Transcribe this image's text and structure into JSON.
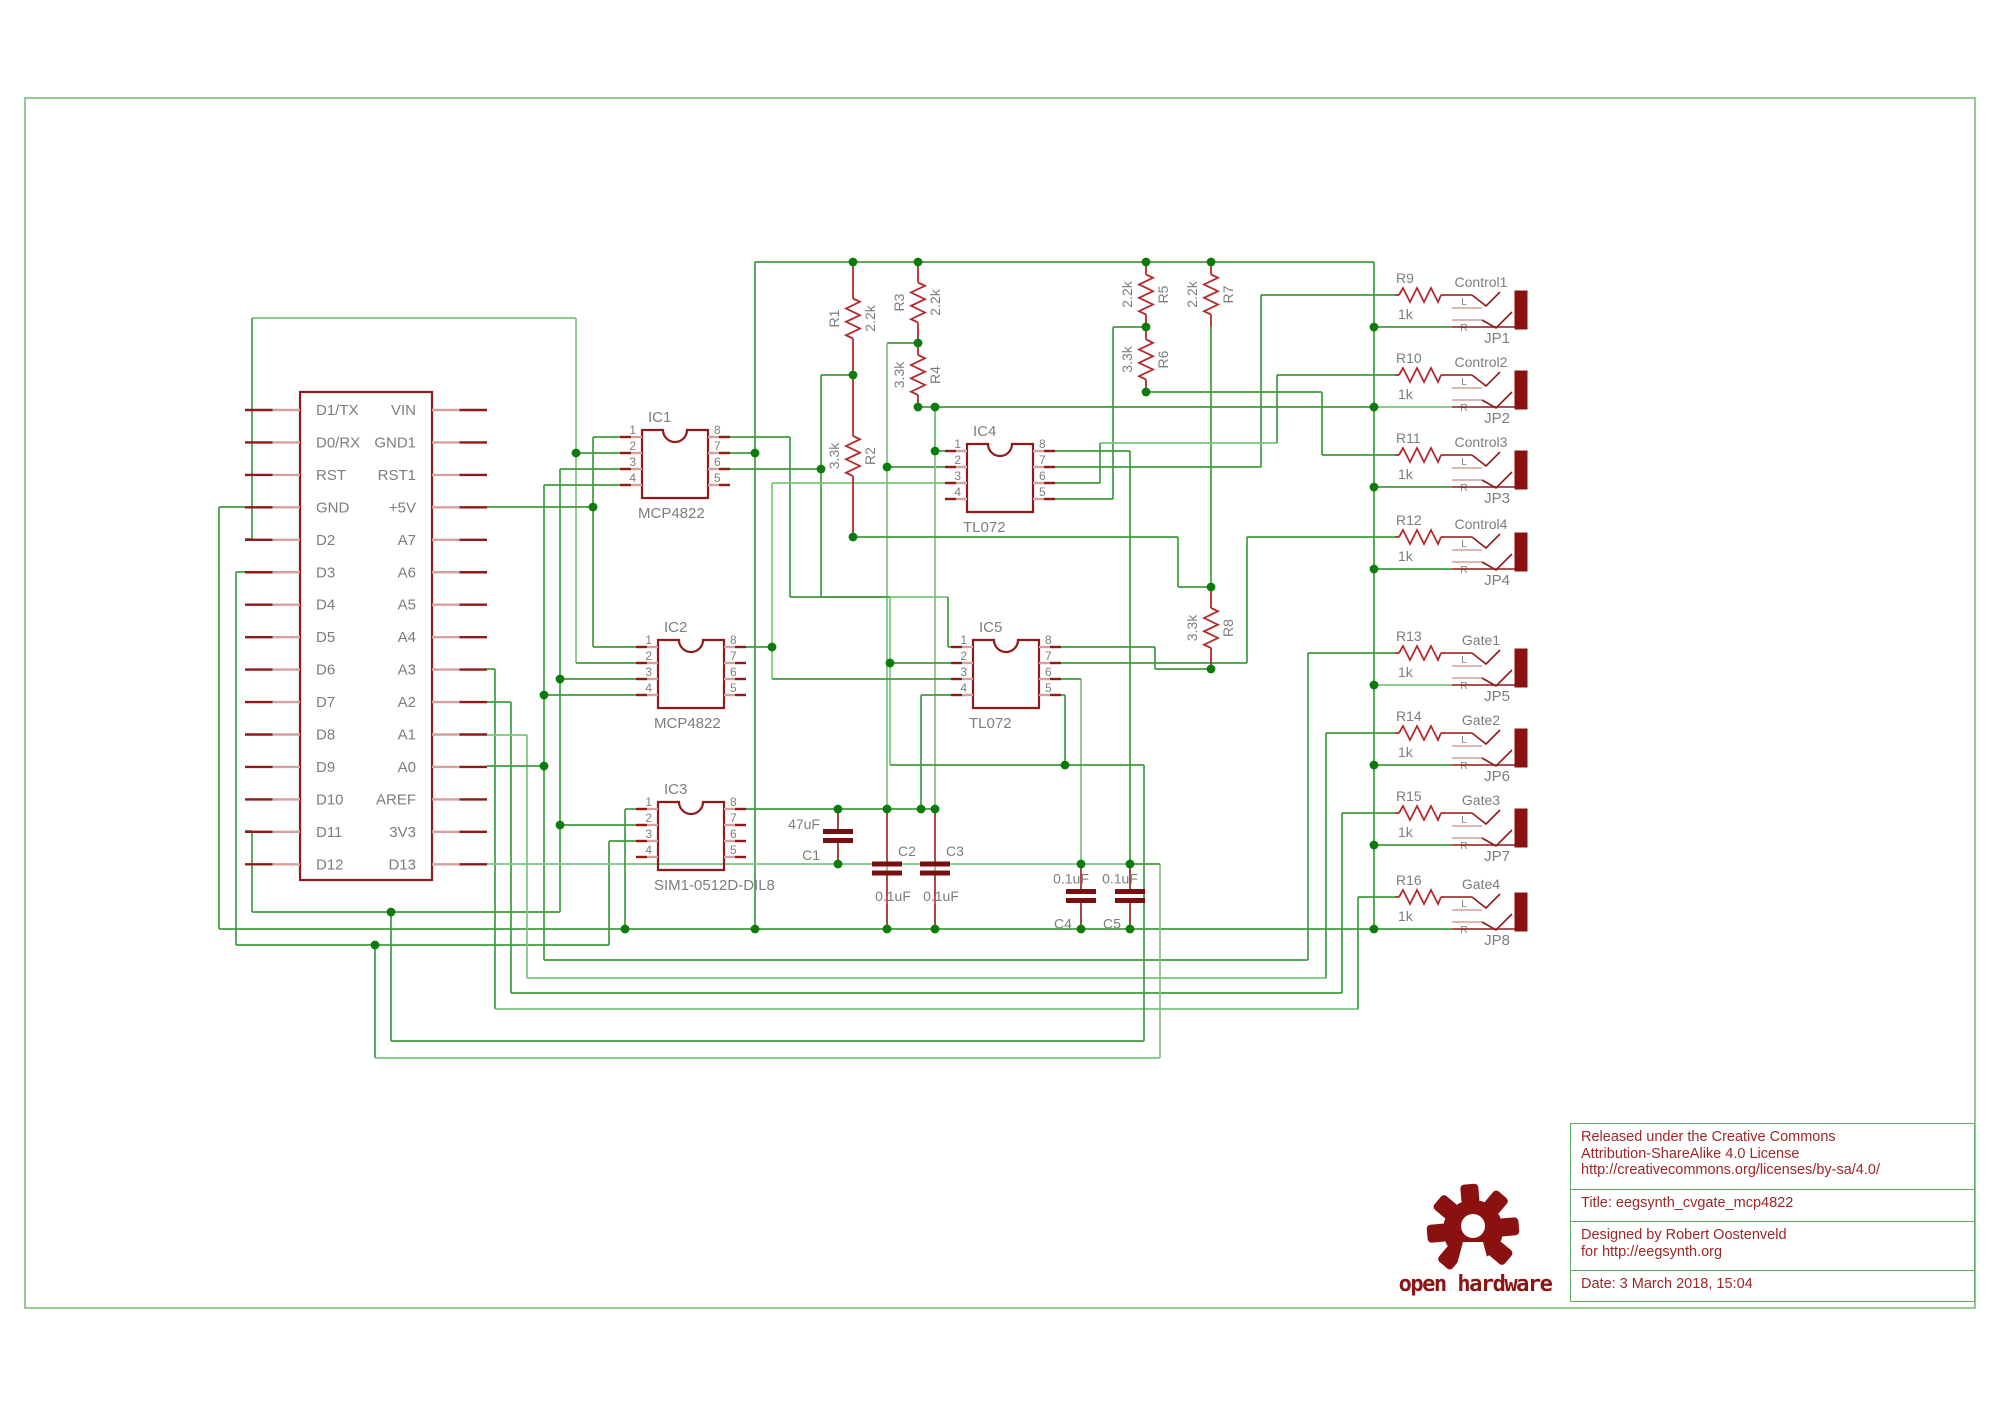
{
  "title_block": {
    "license_lines": [
      "Released under the Creative Commons",
      "Attribution-ShareAlike 4.0 License",
      "http://creativecommons.org/licenses/by-sa/4.0/"
    ],
    "title": "Title: eegsynth_cvgate_mcp4822",
    "designed_lines": [
      "Designed by Robert Oostenveld",
      "for http://eegsynth.org"
    ],
    "date": "Date: 3 March 2018, 15:04"
  },
  "logo": {
    "text": "open hardware"
  },
  "colors": {
    "wire": "#3f9b3f",
    "wire_light": "#7cc57c",
    "junction": "#0b7c0b",
    "symbol": "#8f1a1a",
    "resistor": "#b22a2a",
    "pin_near": "#d4a0a0",
    "pin_far": "#8f1a1a",
    "label": "#7d7d7d",
    "frame": "#66b266",
    "jack_body": "#8b1111",
    "cap": "#7a0f0f"
  },
  "frame": {
    "x": 25,
    "y": 98,
    "w": 1950,
    "h": 1210
  },
  "schematic": {
    "mcu": {
      "x": 300,
      "y": 392,
      "w": 132,
      "h": 488,
      "stub": 55,
      "row0": 410,
      "rowstep": 32.45,
      "left_pins": [
        "D1/TX",
        "D0/RX",
        "RST",
        "GND",
        "D2",
        "D3",
        "D4",
        "D5",
        "D6",
        "D7",
        "D8",
        "D9",
        "D10",
        "D11",
        "D12"
      ],
      "right_pins": [
        "VIN",
        "GND1",
        "RST1",
        "+5V",
        "A7",
        "A6",
        "A5",
        "A4",
        "A3",
        "A2",
        "A1",
        "A0",
        "AREF",
        "3V3",
        "D13"
      ]
    },
    "ics": [
      {
        "ref": "IC1",
        "value": "MCP4822",
        "x": 642,
        "y": 430,
        "w": 66,
        "h": 68
      },
      {
        "ref": "IC2",
        "value": "MCP4822",
        "x": 658,
        "y": 640,
        "w": 66,
        "h": 68
      },
      {
        "ref": "IC3",
        "value": "SIM1-0512D-DIL8",
        "x": 658,
        "y": 802,
        "w": 66,
        "h": 68
      },
      {
        "ref": "IC4",
        "value": "TL072",
        "x": 967,
        "y": 444,
        "w": 66,
        "h": 68
      },
      {
        "ref": "IC5",
        "value": "TL072",
        "x": 973,
        "y": 640,
        "w": 66,
        "h": 68
      }
    ],
    "ic_pin_numbers_left": [
      "1",
      "2",
      "3",
      "4"
    ],
    "ic_pin_numbers_right": [
      "8",
      "7",
      "6",
      "5"
    ],
    "vresistors": [
      {
        "ref": "R1",
        "value": "2.2k",
        "x": 853,
        "y1": 262,
        "y2": 375,
        "refSide": "left"
      },
      {
        "ref": "R2",
        "value": "3.3k",
        "x": 853,
        "y1": 375,
        "y2": 537,
        "refSide": "right"
      },
      {
        "ref": "R3",
        "value": "2.2k",
        "x": 918,
        "y1": 262,
        "y2": 343,
        "refSide": "left"
      },
      {
        "ref": "R4",
        "value": "3.3k",
        "x": 918,
        "y1": 343,
        "y2": 407,
        "refSide": "right"
      },
      {
        "ref": "R5",
        "value": "2.2k",
        "x": 1146,
        "y1": 262,
        "y2": 327,
        "refSide": "right"
      },
      {
        "ref": "R6",
        "value": "3.3k",
        "x": 1146,
        "y1": 327,
        "y2": 392,
        "refSide": "right"
      },
      {
        "ref": "R7",
        "value": "2.2k",
        "x": 1211,
        "y1": 262,
        "y2": 327,
        "refSide": "right"
      },
      {
        "ref": "R8",
        "value": "3.3k",
        "x": 1211,
        "y1": 587,
        "y2": 669,
        "refSide": "right"
      }
    ],
    "jacks": [
      {
        "jp": "JP1",
        "signal": "Control1",
        "ref": "R9",
        "value": "1k",
        "y": 295
      },
      {
        "jp": "JP2",
        "signal": "Control2",
        "ref": "R10",
        "value": "1k",
        "y": 375
      },
      {
        "jp": "JP3",
        "signal": "Control3",
        "ref": "R11",
        "value": "1k",
        "y": 455
      },
      {
        "jp": "JP4",
        "signal": "Control4",
        "ref": "R12",
        "value": "1k",
        "y": 537
      },
      {
        "jp": "JP5",
        "signal": "Gate1",
        "ref": "R13",
        "value": "1k",
        "y": 653
      },
      {
        "jp": "JP6",
        "signal": "Gate2",
        "ref": "R14",
        "value": "1k",
        "y": 733
      },
      {
        "jp": "JP7",
        "signal": "Gate3",
        "ref": "R15",
        "value": "1k",
        "y": 813
      },
      {
        "jp": "JP8",
        "signal": "Gate4",
        "ref": "R16",
        "value": "1k",
        "y": 897
      }
    ],
    "jack_contact_labels": [
      "L",
      "R"
    ],
    "caps": [
      {
        "ref": "C1",
        "value": "47uF",
        "x": 838,
        "top": 809,
        "bot": 864,
        "layout": "left"
      },
      {
        "ref": "C2",
        "value": "0.1uF",
        "x": 887,
        "top": 809,
        "bot": 929,
        "layout": "refAbove"
      },
      {
        "ref": "C3",
        "value": "0.1uF",
        "x": 935,
        "top": 809,
        "bot": 929,
        "layout": "refAbove"
      },
      {
        "ref": "C4",
        "value": "0.1uF",
        "x": 1081,
        "top": 864,
        "bot": 929,
        "layout": "refBelow"
      },
      {
        "ref": "C5",
        "value": "0.1uF",
        "x": 1130,
        "top": 864,
        "bot": 929,
        "layout": "refBelow"
      }
    ],
    "wires": [
      [
        245,
        507,
        219,
        507
      ],
      [
        219,
        507,
        219,
        929
      ],
      [
        219,
        929,
        1374,
        929
      ],
      [
        755,
        262,
        1374,
        262
      ],
      [
        1374,
        262,
        1374,
        929
      ],
      [
        755,
        262,
        755,
        929
      ],
      [
        1374,
        327,
        1452,
        327
      ],
      [
        1374,
        407,
        1452,
        407
      ],
      [
        1374,
        487,
        1452,
        487
      ],
      [
        1374,
        569,
        1452,
        569
      ],
      [
        1374,
        685,
        1452,
        685
      ],
      [
        1374,
        765,
        1452,
        765
      ],
      [
        1374,
        845,
        1452,
        845
      ],
      [
        1374,
        929,
        1452,
        929
      ],
      [
        245,
        539,
        252,
        539
      ],
      [
        252,
        318,
        252,
        539
      ],
      [
        252,
        318,
        576,
        318
      ],
      [
        576,
        318,
        576,
        663
      ],
      [
        576,
        453,
        620,
        453
      ],
      [
        576,
        663,
        636,
        663
      ],
      [
        245,
        572,
        236,
        572
      ],
      [
        236,
        572,
        236,
        945
      ],
      [
        236,
        945,
        609,
        945
      ],
      [
        609,
        841,
        609,
        945
      ],
      [
        609,
        841,
        636,
        841
      ],
      [
        245,
        831,
        252,
        831
      ],
      [
        252,
        831,
        252,
        912
      ],
      [
        252,
        912,
        560,
        912
      ],
      [
        560,
        469,
        560,
        912
      ],
      [
        560,
        469,
        620,
        469
      ],
      [
        560,
        679,
        636,
        679
      ],
      [
        560,
        825,
        636,
        825
      ],
      [
        487,
        507,
        593,
        507
      ],
      [
        593,
        437,
        593,
        647
      ],
      [
        593,
        437,
        620,
        437
      ],
      [
        593,
        647,
        636,
        647
      ],
      [
        487,
        669,
        495,
        669
      ],
      [
        495,
        669,
        495,
        1009
      ],
      [
        495,
        1009,
        1358,
        1009
      ],
      [
        1358,
        897,
        1358,
        1009
      ],
      [
        1358,
        897,
        1395,
        897
      ],
      [
        487,
        702,
        511,
        702
      ],
      [
        511,
        702,
        511,
        993
      ],
      [
        511,
        993,
        1342,
        993
      ],
      [
        1342,
        813,
        1342,
        993
      ],
      [
        1342,
        813,
        1395,
        813
      ],
      [
        487,
        735,
        527,
        735
      ],
      [
        527,
        735,
        527,
        978
      ],
      [
        527,
        978,
        1326,
        978
      ],
      [
        1326,
        733,
        1326,
        978
      ],
      [
        1326,
        733,
        1395,
        733
      ],
      [
        487,
        766,
        544,
        766
      ],
      [
        544,
        485,
        544,
        960
      ],
      [
        544,
        485,
        620,
        485
      ],
      [
        544,
        695,
        636,
        695
      ],
      [
        544,
        960,
        1308,
        960
      ],
      [
        1308,
        653,
        1308,
        960
      ],
      [
        1308,
        653,
        1395,
        653
      ],
      [
        487,
        864,
        1130,
        864
      ],
      [
        745,
        809,
        935,
        809
      ],
      [
        625,
        809,
        625,
        929
      ],
      [
        625,
        809,
        636,
        809
      ],
      [
        918,
        407,
        1374,
        407
      ],
      [
        935,
        407,
        935,
        451
      ],
      [
        935,
        451,
        945,
        451
      ],
      [
        887,
        343,
        918,
        343
      ],
      [
        887,
        343,
        887,
        896
      ],
      [
        887,
        467,
        945,
        467
      ],
      [
        887,
        904,
        887,
        929
      ],
      [
        935,
        407,
        935,
        896
      ],
      [
        935,
        904,
        935,
        929
      ],
      [
        838,
        809,
        838,
        830
      ],
      [
        838,
        838,
        838,
        864
      ],
      [
        1081,
        679,
        1081,
        894
      ],
      [
        1081,
        902,
        1081,
        929
      ],
      [
        1061,
        679,
        1081,
        679
      ],
      [
        1130,
        451,
        1130,
        894
      ],
      [
        1130,
        902,
        1130,
        929
      ],
      [
        1055,
        451,
        1130,
        451
      ],
      [
        821,
        375,
        853,
        375
      ],
      [
        821,
        375,
        821,
        597
      ],
      [
        821,
        597,
        948,
        597
      ],
      [
        948,
        597,
        948,
        647
      ],
      [
        948,
        647,
        951,
        647
      ],
      [
        730,
        469,
        821,
        469
      ],
      [
        730,
        453,
        755,
        453
      ],
      [
        853,
        537,
        1178,
        537
      ],
      [
        1178,
        537,
        1178,
        587
      ],
      [
        1178,
        587,
        1211,
        587
      ],
      [
        1113,
        327,
        1146,
        327
      ],
      [
        1113,
        327,
        1113,
        499
      ],
      [
        1055,
        499,
        1113,
        499
      ],
      [
        1146,
        392,
        1322,
        392
      ],
      [
        1322,
        392,
        1322,
        455
      ],
      [
        1322,
        455,
        1395,
        455
      ],
      [
        1211,
        327,
        1211,
        587
      ],
      [
        1061,
        647,
        1155,
        647
      ],
      [
        1155,
        647,
        1155,
        669
      ],
      [
        1155,
        669,
        1211,
        669
      ],
      [
        1061,
        663,
        1247,
        663
      ],
      [
        1247,
        537,
        1247,
        663
      ],
      [
        1247,
        537,
        1395,
        537
      ],
      [
        1055,
        467,
        1261,
        467
      ],
      [
        1261,
        295,
        1261,
        467
      ],
      [
        1261,
        295,
        1395,
        295
      ],
      [
        1055,
        483,
        1100,
        483
      ],
      [
        1100,
        443,
        1100,
        483
      ],
      [
        1100,
        443,
        1277,
        443
      ],
      [
        1277,
        375,
        1277,
        443
      ],
      [
        1277,
        375,
        1395,
        375
      ],
      [
        730,
        437,
        790,
        437
      ],
      [
        790,
        437,
        790,
        597
      ],
      [
        790,
        597,
        890,
        597
      ],
      [
        890,
        597,
        890,
        765
      ],
      [
        890,
        663,
        951,
        663
      ],
      [
        921,
        695,
        951,
        695
      ],
      [
        921,
        695,
        921,
        809
      ],
      [
        1061,
        695,
        1065,
        695
      ],
      [
        1065,
        695,
        1065,
        765
      ],
      [
        890,
        765,
        1144,
        765
      ],
      [
        746,
        647,
        772,
        647
      ],
      [
        772,
        483,
        772,
        679
      ],
      [
        772,
        483,
        945,
        483
      ],
      [
        772,
        679,
        951,
        679
      ],
      [
        391,
        912,
        391,
        1041
      ],
      [
        391,
        1041,
        1144,
        1041
      ],
      [
        1144,
        765,
        1144,
        1041
      ],
      [
        375,
        945,
        375,
        1058
      ],
      [
        375,
        1058,
        1160,
        1058
      ],
      [
        1160,
        864,
        1160,
        1058
      ],
      [
        1130,
        864,
        1160,
        864
      ]
    ],
    "wires_light": [
      [
        252,
        318,
        576,
        318
      ],
      [
        576,
        318,
        576,
        663
      ],
      [
        487,
        735,
        527,
        735
      ],
      [
        527,
        735,
        527,
        978
      ],
      [
        527,
        978,
        1326,
        978
      ],
      [
        487,
        864,
        1130,
        864
      ],
      [
        887,
        343,
        887,
        896
      ],
      [
        935,
        407,
        935,
        896
      ],
      [
        772,
        483,
        772,
        679
      ],
      [
        772,
        483,
        945,
        483
      ],
      [
        1081,
        679,
        1081,
        894
      ],
      [
        821,
        597,
        948,
        597
      ],
      [
        890,
        597,
        890,
        765
      ],
      [
        375,
        1058,
        1160,
        1058
      ],
      [
        1160,
        864,
        1160,
        1058
      ],
      [
        1100,
        443,
        1277,
        443
      ],
      [
        495,
        1009,
        1358,
        1009
      ],
      [
        1374,
        407,
        1452,
        407
      ],
      [
        1374,
        685,
        1452,
        685
      ]
    ],
    "junctions": [
      [
        593,
        507
      ],
      [
        576,
        453
      ],
      [
        560,
        679
      ],
      [
        560,
        825
      ],
      [
        544,
        695
      ],
      [
        544,
        766
      ],
      [
        853,
        262
      ],
      [
        918,
        262
      ],
      [
        1146,
        262
      ],
      [
        1211,
        262
      ],
      [
        853,
        375
      ],
      [
        918,
        343
      ],
      [
        918,
        407
      ],
      [
        935,
        407
      ],
      [
        935,
        451
      ],
      [
        1374,
        407
      ],
      [
        887,
        467
      ],
      [
        887,
        809
      ],
      [
        935,
        809
      ],
      [
        921,
        809
      ],
      [
        838,
        809
      ],
      [
        1374,
        327
      ],
      [
        1374,
        487
      ],
      [
        1374,
        569
      ],
      [
        1374,
        685
      ],
      [
        1374,
        765
      ],
      [
        1374,
        845
      ],
      [
        1374,
        929
      ],
      [
        838,
        864
      ],
      [
        1081,
        864
      ],
      [
        1130,
        864
      ],
      [
        887,
        929
      ],
      [
        935,
        929
      ],
      [
        1081,
        929
      ],
      [
        1130,
        929
      ],
      [
        625,
        929
      ],
      [
        755,
        929
      ],
      [
        1146,
        327
      ],
      [
        1146,
        392
      ],
      [
        1211,
        587
      ],
      [
        1211,
        669
      ],
      [
        853,
        537
      ],
      [
        755,
        453
      ],
      [
        821,
        469
      ],
      [
        890,
        663
      ],
      [
        772,
        647
      ],
      [
        391,
        912
      ],
      [
        375,
        945
      ],
      [
        1065,
        765
      ]
    ]
  }
}
